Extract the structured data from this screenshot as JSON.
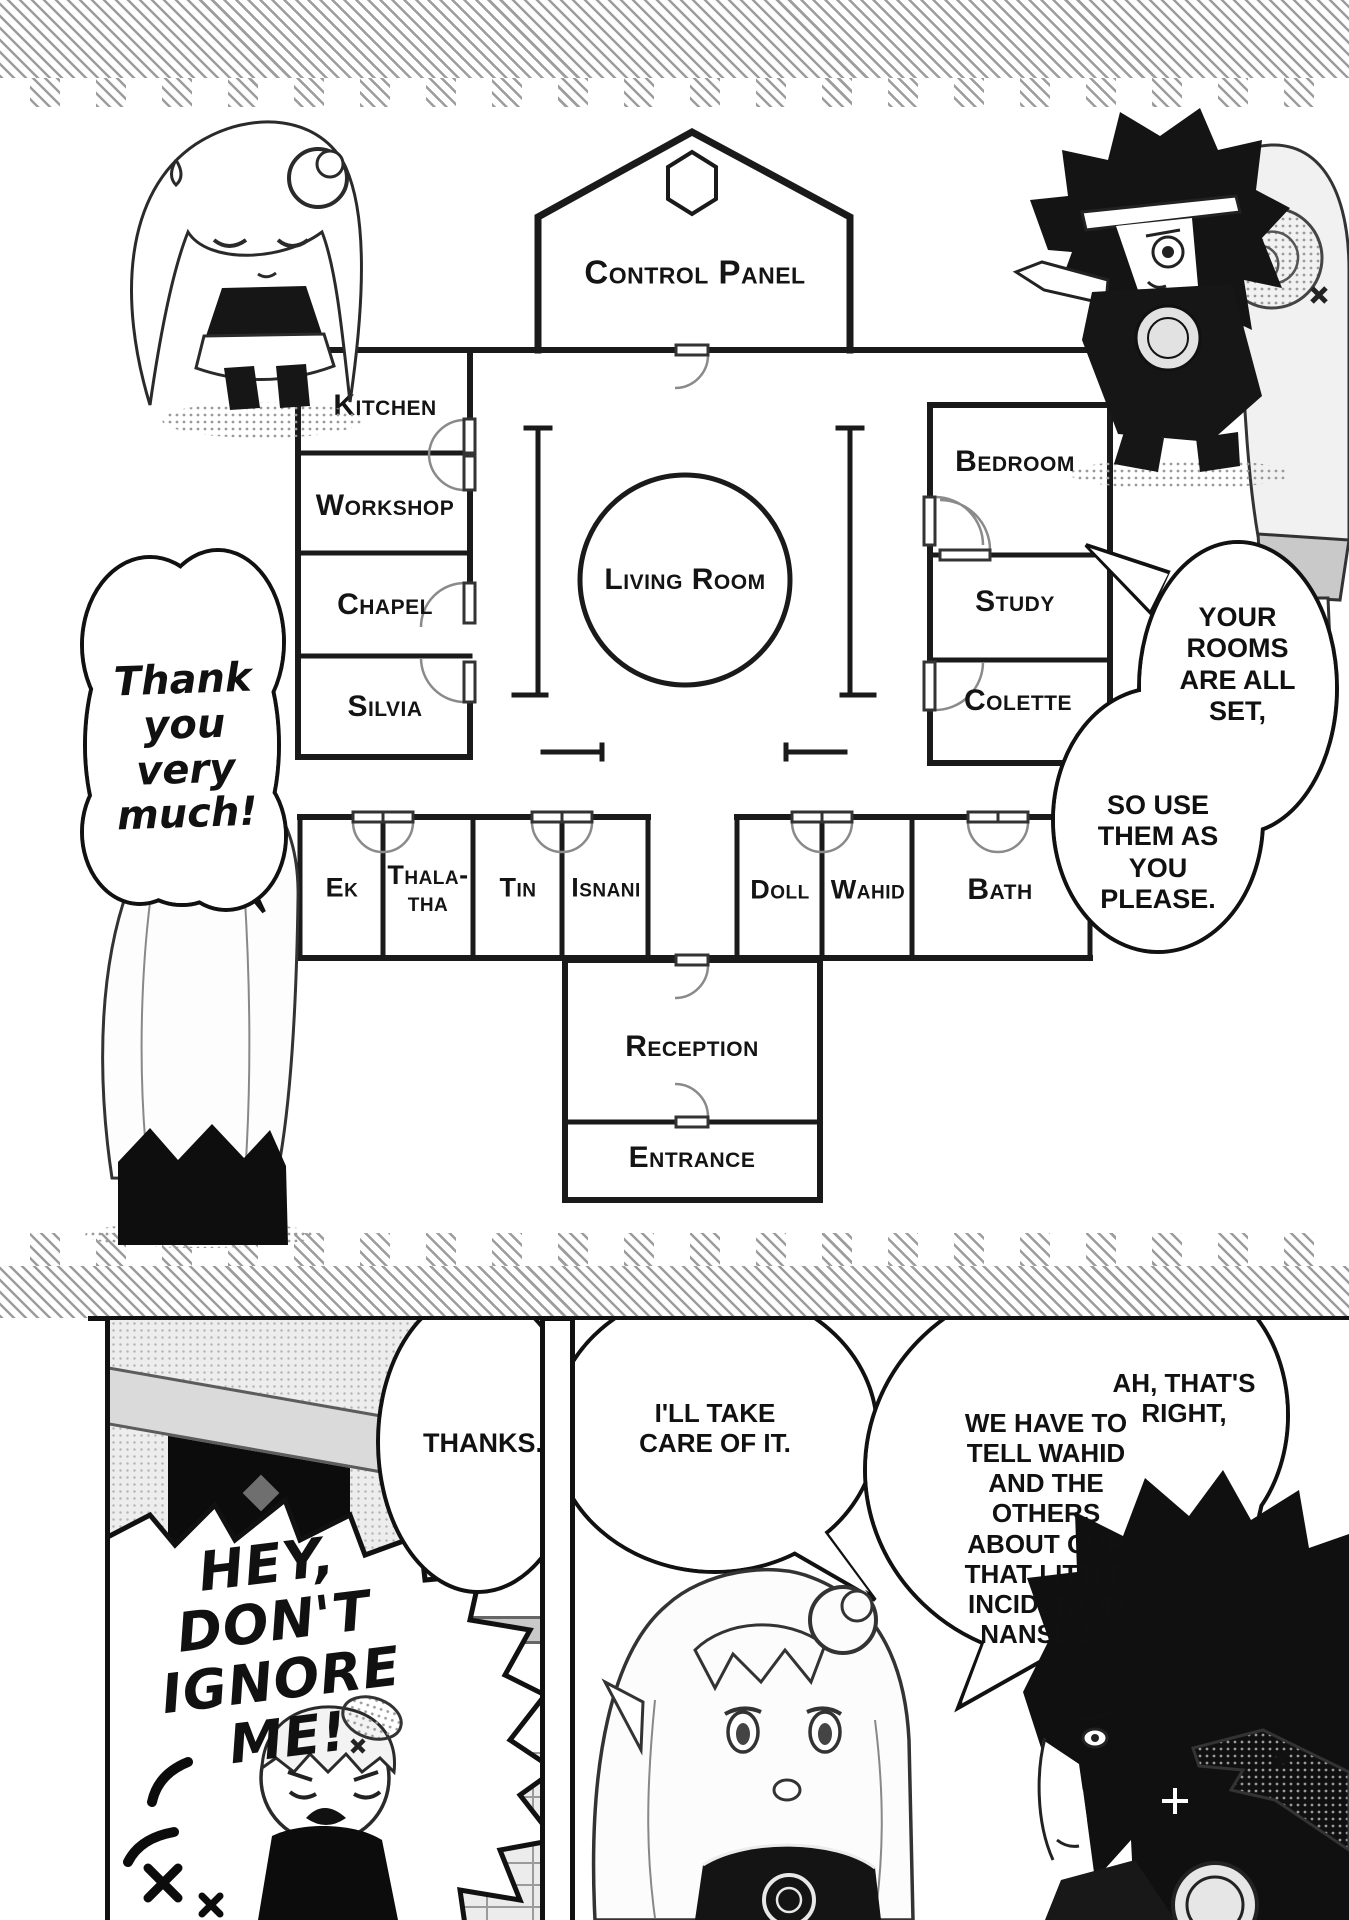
{
  "floor_plan": {
    "rooms": {
      "control_panel": "Control Panel",
      "kitchen": "Kitchen",
      "workshop": "Workshop",
      "chapel": "Chapel",
      "silvia": "Silvia",
      "living_room": "Living Room",
      "bedroom": "Bedroom",
      "study": "Study",
      "colette": "Colette",
      "ek": "Ek",
      "thalatha": "Thala-tha",
      "tin": "Tin",
      "isnani": "Isnani",
      "doll": "Doll",
      "wahid": "Wahid",
      "bath": "Bath",
      "reception": "Reception",
      "entrance": "Entrance"
    }
  },
  "dialogue": {
    "thank_you": "Thank you very much!",
    "rooms_set": "YOUR ROOMS ARE ALL SET,",
    "use_them": "SO USE THEM AS YOU PLEASE.",
    "thanks": "THANKS.",
    "take_care": "I'LL TAKE CARE OF IT.",
    "ah_thats_right": "AH, THAT'S RIGHT,",
    "tell_wahid": "WE HAVE TO TELL WAHID AND THE OTHERS ABOUT OUR THAT LITTLE INCIDENT IN NANSEN...",
    "shout": "HEY, DON'T IGNORE ME!"
  },
  "colors": {
    "ink": "#1a1a1a",
    "paper": "#ffffff",
    "tone_gray": "#c8c8c8"
  }
}
